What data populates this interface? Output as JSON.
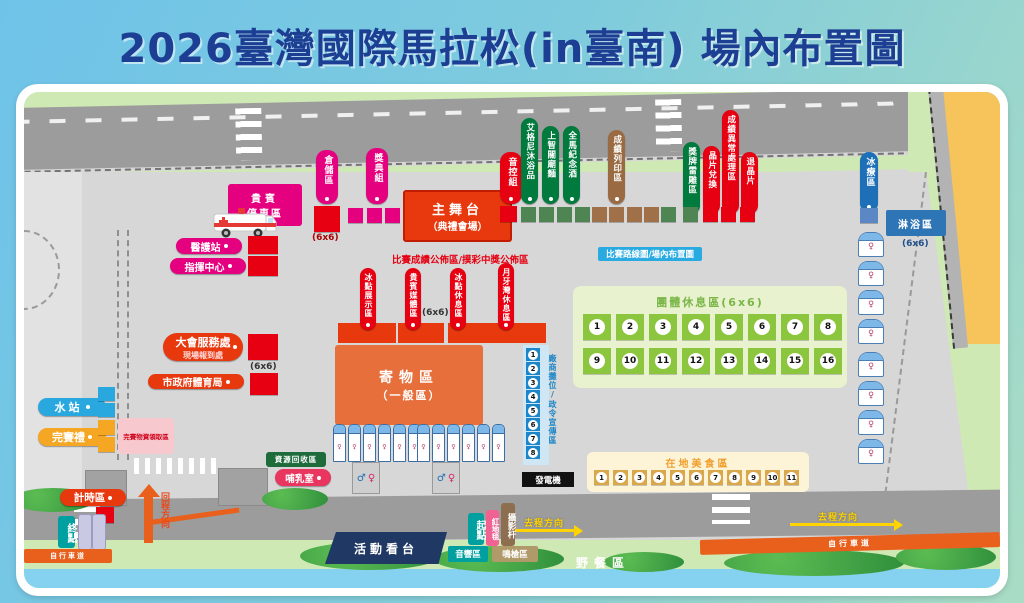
{
  "title": "2026臺灣國際馬拉松(in臺南) 場內布置圖",
  "labels": {
    "size_6x6": "(6x6)"
  },
  "top": {
    "vip_parking_l1": "貴賓",
    "vip_parking_l2": "停車區",
    "medical": "醫護站",
    "command": "指揮中心",
    "storage": "倉儲區",
    "awards": "獎典組",
    "stage_l1": "主舞台",
    "stage_l2": "（典禮會場）",
    "sound": "音控組",
    "sponsors": [
      "艾格尼沐浴品",
      "上智關廟麵",
      "全馬紀念酒"
    ],
    "print": "成績列印區",
    "medal": "獎牌雷雕區",
    "chip_exchange": "晶片兌換",
    "abnormal": "成績異常處理區",
    "chip_return": "退晶片",
    "ice_therapy": "冰療區",
    "shower": "淋浴區"
  },
  "banners": {
    "results": "比賽成績公佈區/摸彩中獎公佈區",
    "route": "比賽路線圖/場內布置圖"
  },
  "center": {
    "booths": [
      "冰點展示區",
      "貴賓媒體區",
      "冰點休息區",
      "月牙灣休息區"
    ],
    "baggage_l1": "寄物區",
    "baggage_l2": "（一般區）",
    "vendor_label": "廠商攤位/政令宣傳區",
    "vendor_numbers": [
      1,
      2,
      3,
      4,
      5,
      6,
      7,
      8
    ],
    "generator": "發電機",
    "recycle": "資源回收區",
    "nursing": "哺乳室"
  },
  "left": {
    "service_l1": "大會服務處",
    "service_l2": "現場報到處",
    "bureau": "市政府體育局",
    "water": "水站",
    "gift": "完賽禮",
    "goods": "完賽物資領取區",
    "timing": "計時區",
    "finish": "終點",
    "return_dir": "回程方向"
  },
  "rest_area": {
    "title": "團體休息區(6x6)",
    "row1": [
      1,
      2,
      3,
      4,
      5,
      6,
      7,
      8
    ],
    "row2": [
      9,
      10,
      11,
      12,
      13,
      14,
      15,
      16
    ]
  },
  "food_area": {
    "title": "在地美食區",
    "numbers": [
      1,
      2,
      3,
      4,
      5,
      6,
      7,
      8,
      9,
      10,
      11
    ]
  },
  "bottom": {
    "grandstand": "活動看台",
    "sound_area": "音響區",
    "start": "起點",
    "red_carpet": "紅地毯",
    "photo_pole": "攝影杆",
    "gun_area": "鳴槍區",
    "outbound": "去程方向",
    "picnic": "野餐區",
    "bike_lane": "自行車道"
  }
}
